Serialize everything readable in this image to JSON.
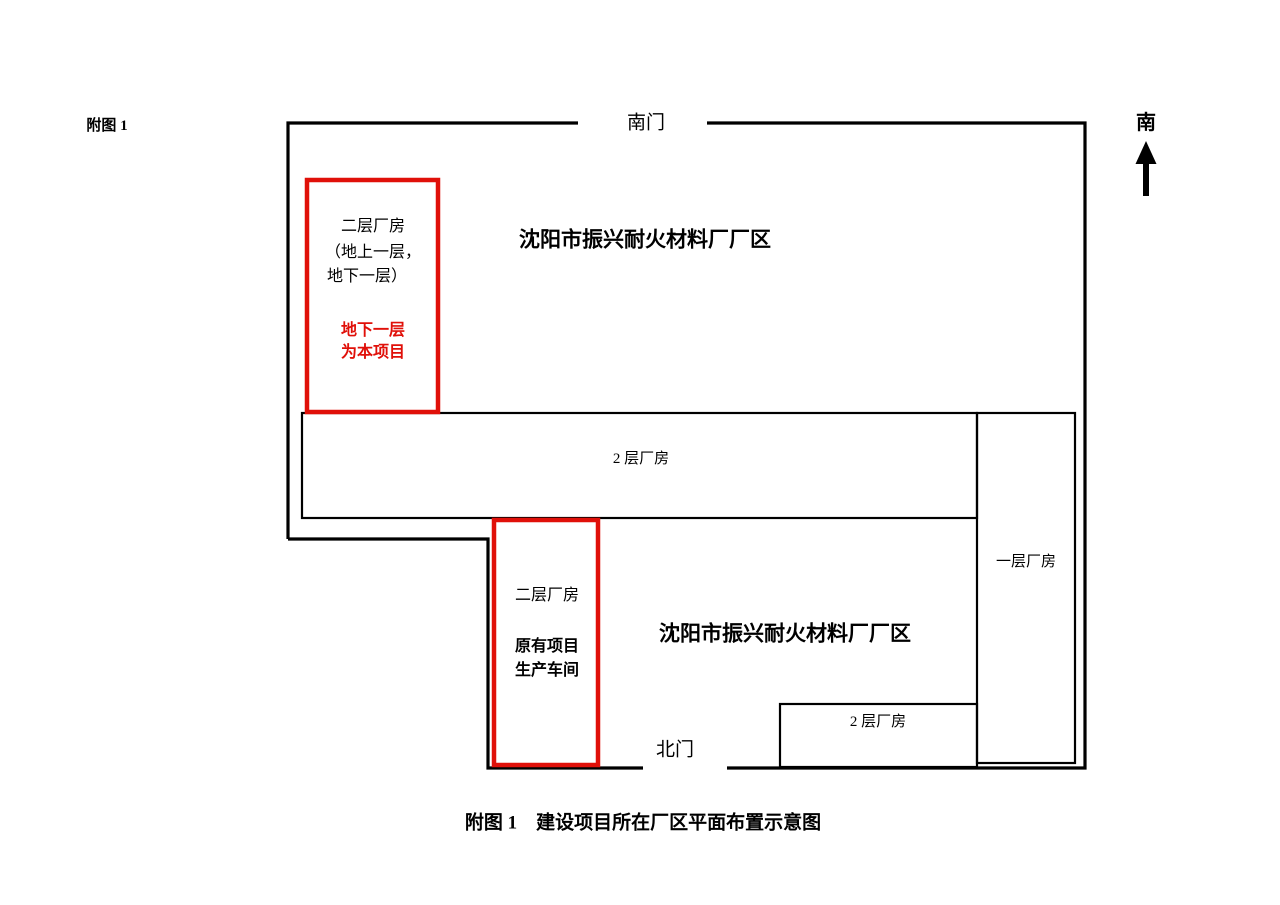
{
  "figure": {
    "corner_label": "附图 1",
    "caption": "附图 1　建设项目所在厂区平面布置示意图"
  },
  "compass": {
    "direction_label": "南"
  },
  "gates": {
    "south_gate": "南门",
    "north_gate": "北门"
  },
  "areas": {
    "upper_label": "沈阳市振兴耐火材料厂厂区",
    "lower_label": "沈阳市振兴耐火材料厂厂区"
  },
  "buildings": {
    "project_building": {
      "line1": "二层厂房",
      "line2": "（地上一层，",
      "line3": "地下一层）",
      "highlight_line1": "地下一层",
      "highlight_line2": "为本项目"
    },
    "existing_building": {
      "line1": "二层厂房",
      "line2": "原有项目",
      "line3": "生产车间"
    },
    "two_storey_mid": "2 层厂房",
    "one_storey_right": "一层厂房",
    "two_storey_bottom": "2 层厂房"
  },
  "colors": {
    "highlight_red": "#e01009",
    "line_black": "#000000",
    "background": "#ffffff"
  }
}
